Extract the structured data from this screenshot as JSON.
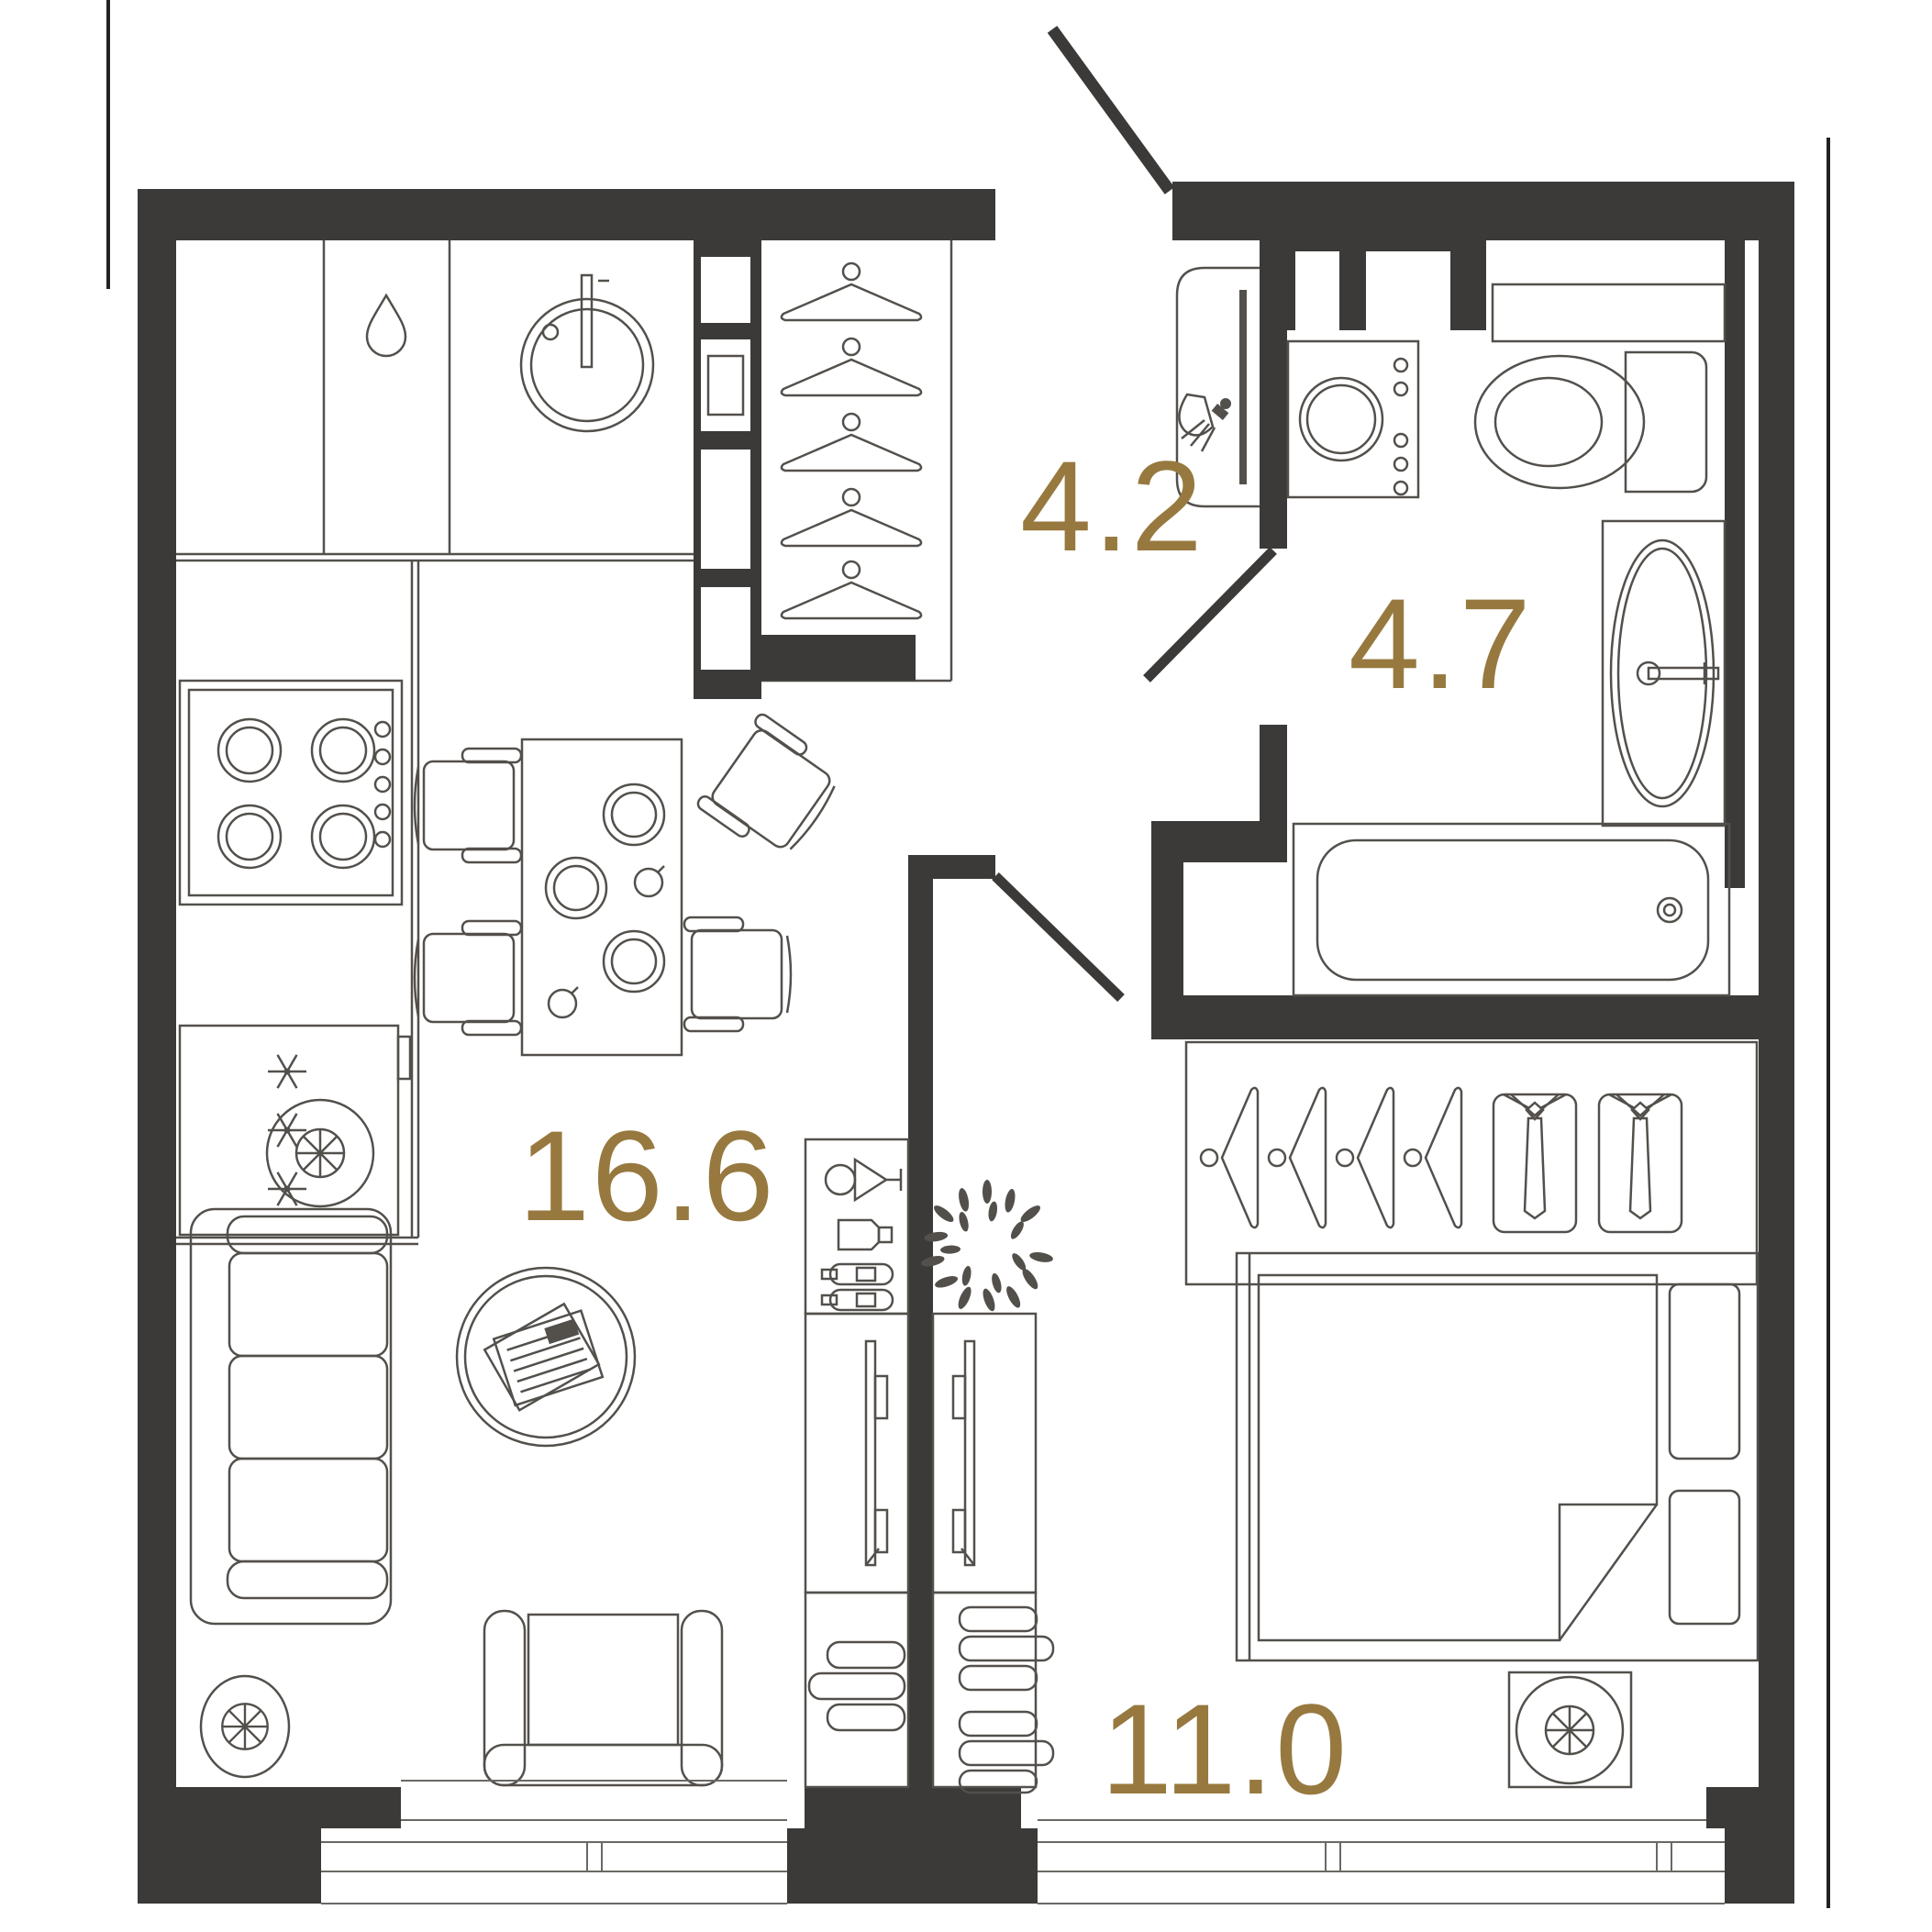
{
  "plan_title": "one-bedroom apartment floor plan",
  "colors": {
    "wall": "#3b3a38",
    "furniture_line": "#53504c",
    "accent_label": "#97793f",
    "background": "#ffffff"
  },
  "rooms": {
    "living_kitchen": {
      "label": "16.6"
    },
    "hallway": {
      "label": "4.2"
    },
    "bathroom": {
      "label": "4.7"
    },
    "bedroom": {
      "label": "11.0"
    }
  },
  "fixtures": {
    "kitchen": [
      "counter",
      "dishwasher-droplet-icon",
      "round-sink-icon",
      "faucet-icon",
      "stove-burners-icon",
      "fridge-snowflake-icon",
      "oven-tower"
    ],
    "hallway": [
      "coat-hanger-icon",
      "mirror-console",
      "wall-sconce-icon",
      "entrance-door",
      "bathroom-door"
    ],
    "bathroom": [
      "ventilation-shaft",
      "washing-machine-icon",
      "toilet-icon",
      "vanity-oval-sink-icon",
      "bathtub-icon",
      "drain-icon"
    ],
    "living_room": [
      "dining-table",
      "plate-icon",
      "cup-icon",
      "dining-chair-icon",
      "sofa-icon",
      "floor-lamp-icon",
      "coffee-table",
      "newspaper-icon",
      "armchair-icon",
      "bar-cabinet",
      "martini-icon",
      "shaker-icon",
      "bottle-icon",
      "tv-console",
      "tv-icon",
      "books-icon"
    ],
    "bedroom": [
      "wardrobe-hanger-icon",
      "shirt-tie-icon",
      "double-bed-icon",
      "pillow-icon",
      "folded-duvet",
      "bedside-lamp-icon",
      "tv-console",
      "tv-icon",
      "books-icon",
      "wreath-plant-icon",
      "bedroom-door"
    ],
    "windows": [
      "living-room-window",
      "bedroom-window"
    ]
  }
}
